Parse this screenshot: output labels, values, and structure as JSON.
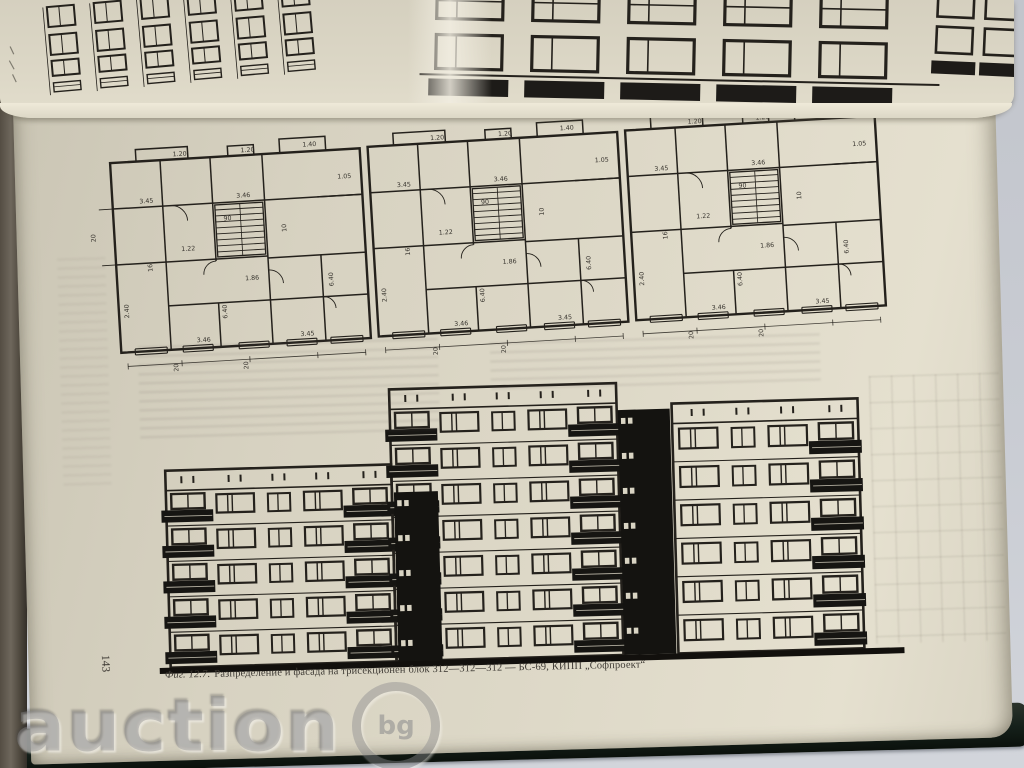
{
  "colors": {
    "background": "#c9ccd3",
    "book_cover": "#15201a",
    "page": "#d9d4c3",
    "ink": "#24211c",
    "watermark": "#8a8a8d"
  },
  "page": {
    "number": "143",
    "caption": {
      "figure_label": "Фиг. 12.7.",
      "text": "Разпределение и фасада на трисекционен блок 312—312—312 — БС-69, КИПП „Софпроект“"
    }
  },
  "watermark": {
    "text": "auction",
    "badge": "bg"
  },
  "floor_plan": {
    "sections": 3,
    "labels": [
      "1.20",
      "1.20",
      "1.40",
      "3.45",
      "3.46",
      "1.05",
      "1.22",
      "90",
      "10",
      "1.86",
      "16",
      "6.40",
      "3.46",
      "3.45",
      "2.40",
      "6.40"
    ],
    "bottom_labels": [
      "20",
      "20",
      "20"
    ],
    "left_labels": [
      "20"
    ]
  },
  "facade": {
    "parapet_height": 20,
    "ground": {
      "x1": 131,
      "x2": 876,
      "y": 562
    },
    "sections": [
      {
        "name": "left",
        "floors": 5,
        "x": 142,
        "width": 226,
        "top": 365,
        "columns": [
          "balcony",
          "window",
          "window_small",
          "window",
          "balcony"
        ]
      },
      {
        "name": "middle",
        "floors": 7,
        "x": 368,
        "width": 227,
        "top": 290,
        "columns": [
          "balcony",
          "window",
          "window_small",
          "window",
          "balcony"
        ]
      },
      {
        "name": "right",
        "floors": 6,
        "x": 650,
        "width": 186,
        "top": 312,
        "columns": [
          "window",
          "window_small",
          "window",
          "balcony"
        ]
      }
    ],
    "stair_strips": [
      {
        "x": 370,
        "w": 44,
        "top": 393
      },
      {
        "x": 596,
        "w": 52,
        "top": 317
      }
    ]
  }
}
